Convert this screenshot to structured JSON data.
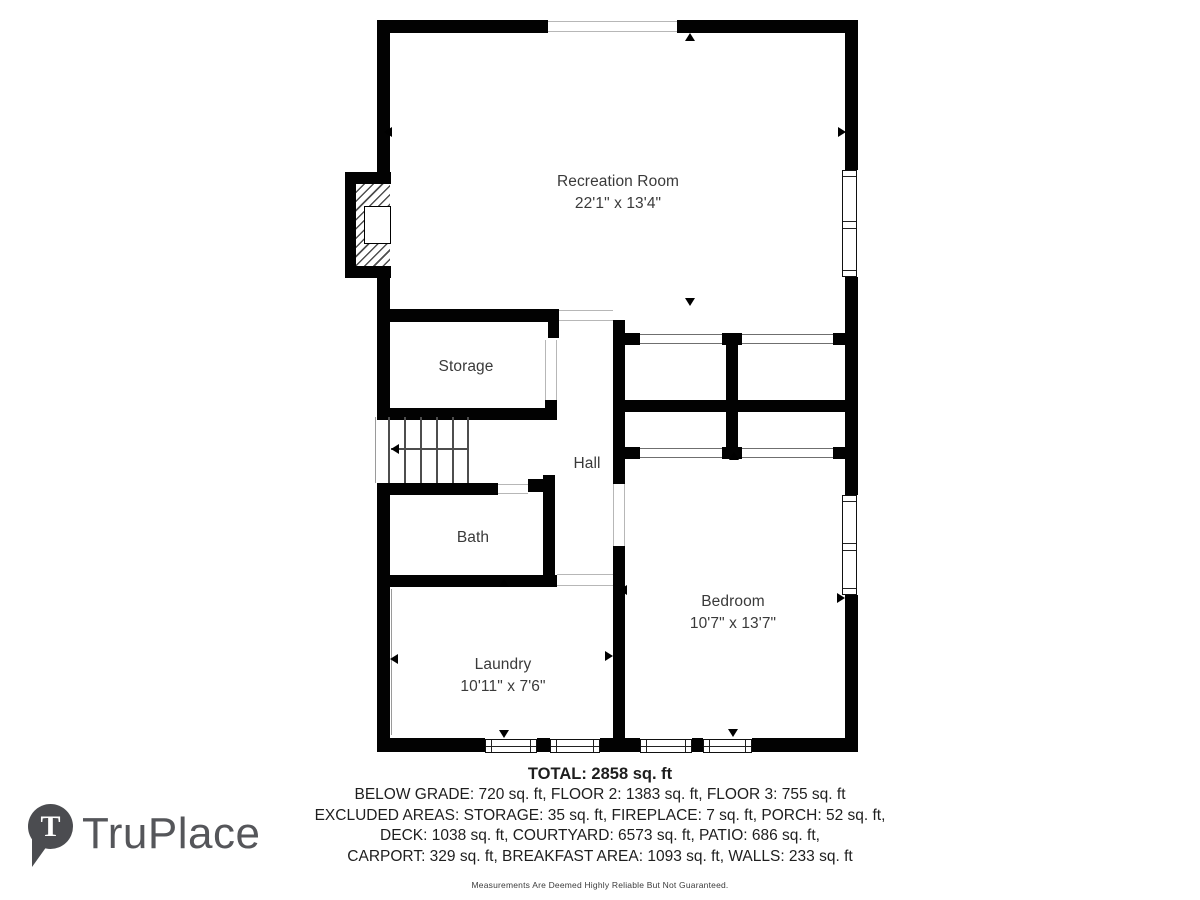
{
  "rooms": {
    "recreation": {
      "name": "Recreation Room",
      "dims": "22'1\" x 13'4\""
    },
    "storage": {
      "name": "Storage"
    },
    "hall": {
      "name": "Hall"
    },
    "bath": {
      "name": "Bath"
    },
    "laundry": {
      "name": "Laundry",
      "dims": "10'11\" x 7'6\""
    },
    "bedroom": {
      "name": "Bedroom",
      "dims": "10'7\" x 13'7\""
    }
  },
  "summary": {
    "total": "TOTAL: 2858 sq. ft",
    "line1": "BELOW GRADE: 720 sq. ft, FLOOR 2: 1383 sq. ft, FLOOR 3: 755 sq. ft",
    "line2": "EXCLUDED AREAS: STORAGE: 35 sq. ft, FIREPLACE: 7 sq. ft, PORCH: 52 sq. ft,",
    "line3": "DECK: 1038 sq. ft, COURTYARD: 6573 sq. ft, PATIO: 686 sq. ft,",
    "line4": "CARPORT: 329 sq. ft, BREAKFAST AREA: 1093 sq. ft, WALLS: 233 sq. ft",
    "disclaimer": "Measurements Are Deemed Highly Reliable But Not Guaranteed."
  },
  "logo": {
    "brand": "TruPlace",
    "mark_letter": "T"
  },
  "colors": {
    "wall": "#020202",
    "opening_line": "#b7b7b7",
    "label": "#3a3a3a",
    "logo_gray": "#55565a"
  }
}
